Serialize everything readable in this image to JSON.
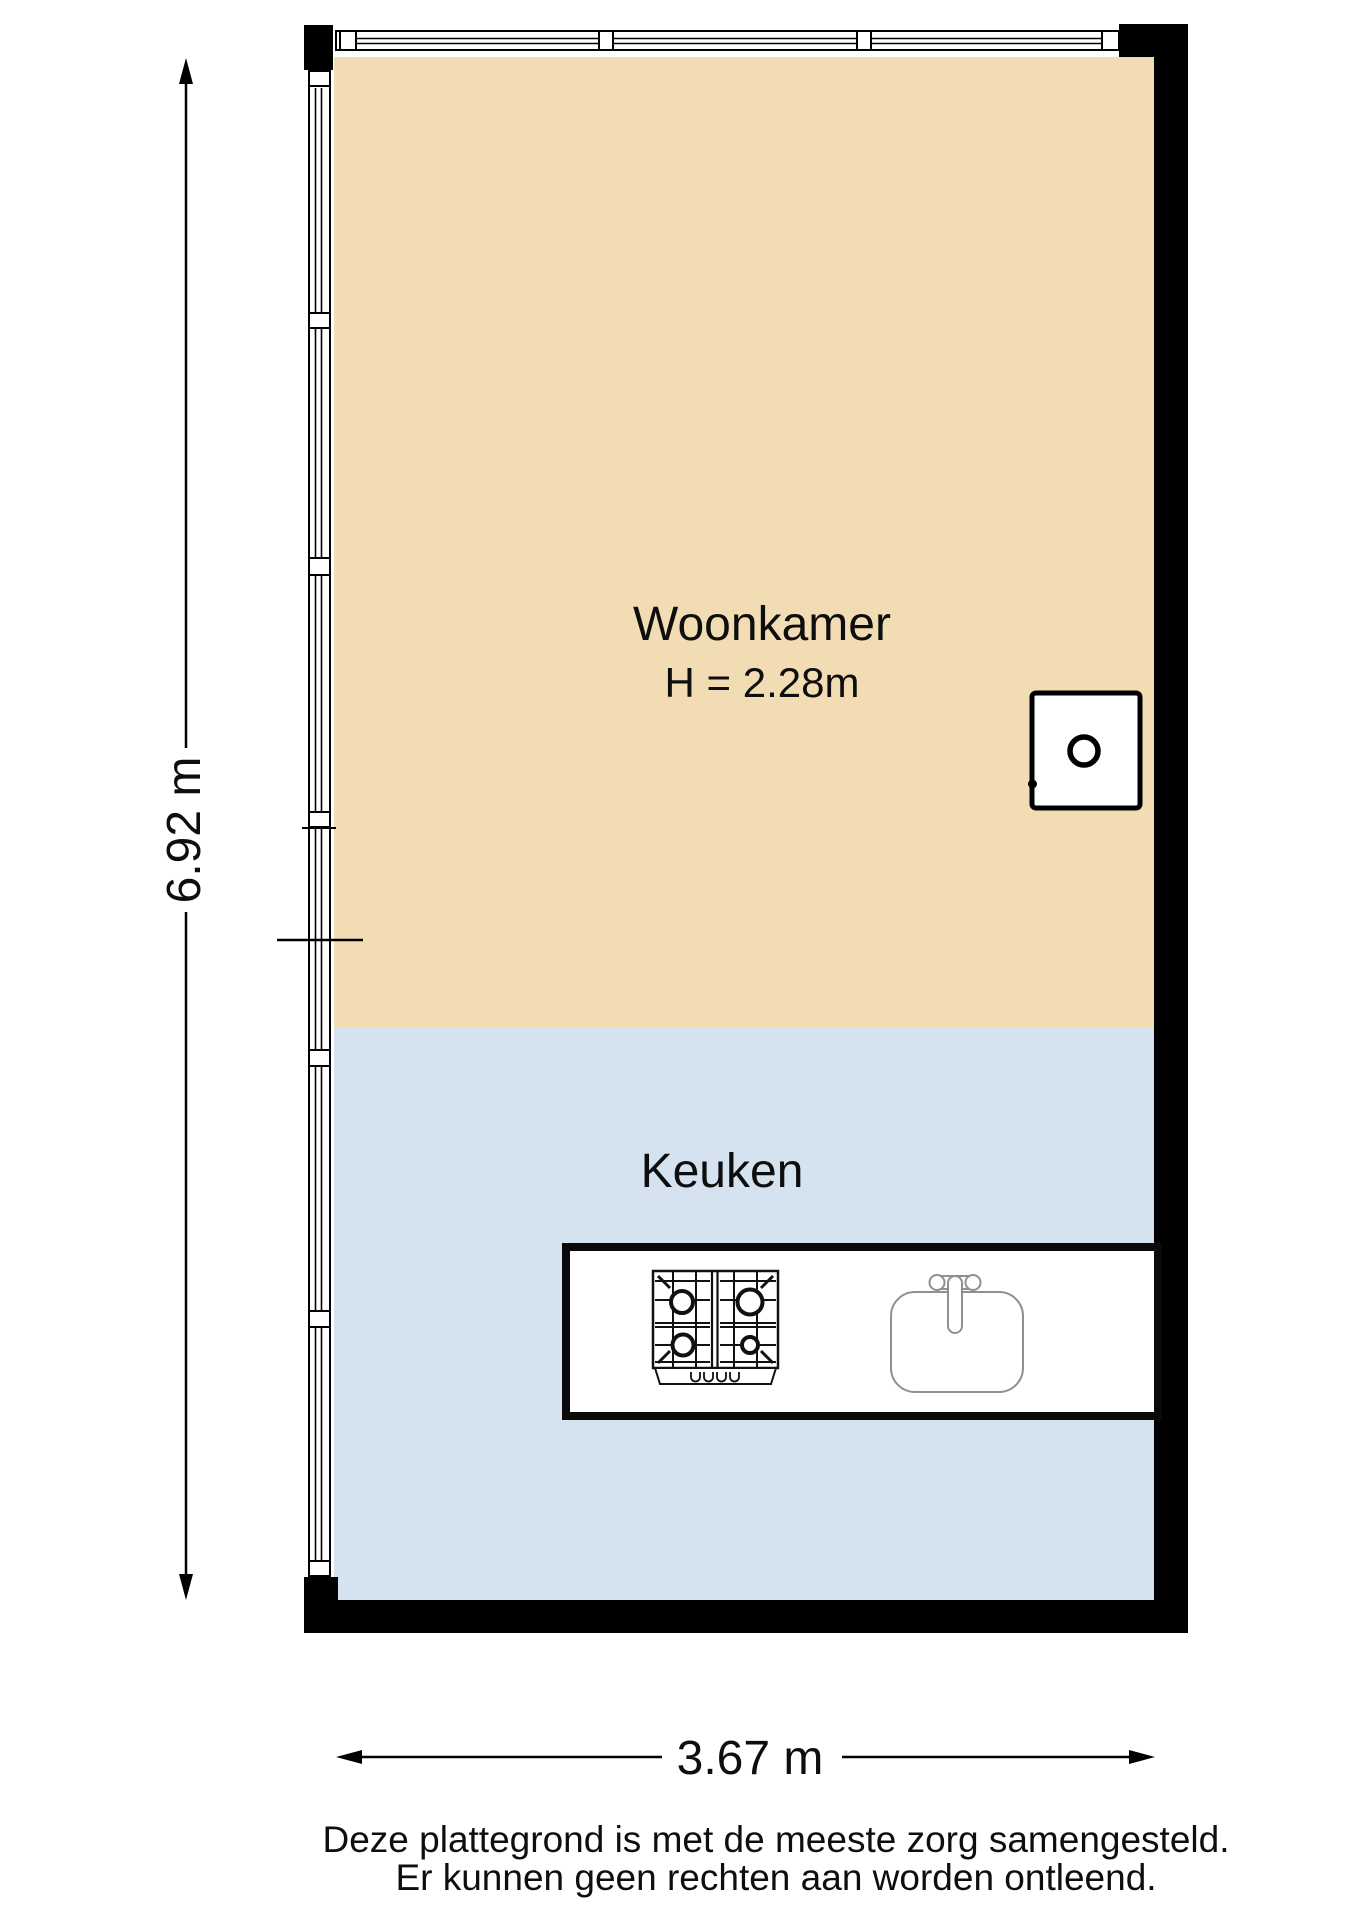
{
  "rooms": {
    "woonkamer": {
      "label": "Woonkamer",
      "ceiling_height": "H = 2.28m"
    },
    "keuken": {
      "label": "Keuken"
    }
  },
  "dimensions": {
    "vertical": "6.92 m",
    "horizontal": "3.67 m"
  },
  "fixtures": {
    "boiler": "boiler-unit",
    "stove": "gas-hob-four-burners",
    "sink": "kitchen-sink-with-faucet",
    "counter": "kitchen-counter"
  },
  "disclaimer": [
    "Deze plattegrond is met de meeste zorg samengesteld.",
    "Er kunnen geen rechten aan worden ontleend."
  ],
  "colors": {
    "woonkamer_fill": "#f2dcb3",
    "keuken_fill": "#d5e3f0",
    "wall": "#000000",
    "sink_stroke": "#909090"
  }
}
